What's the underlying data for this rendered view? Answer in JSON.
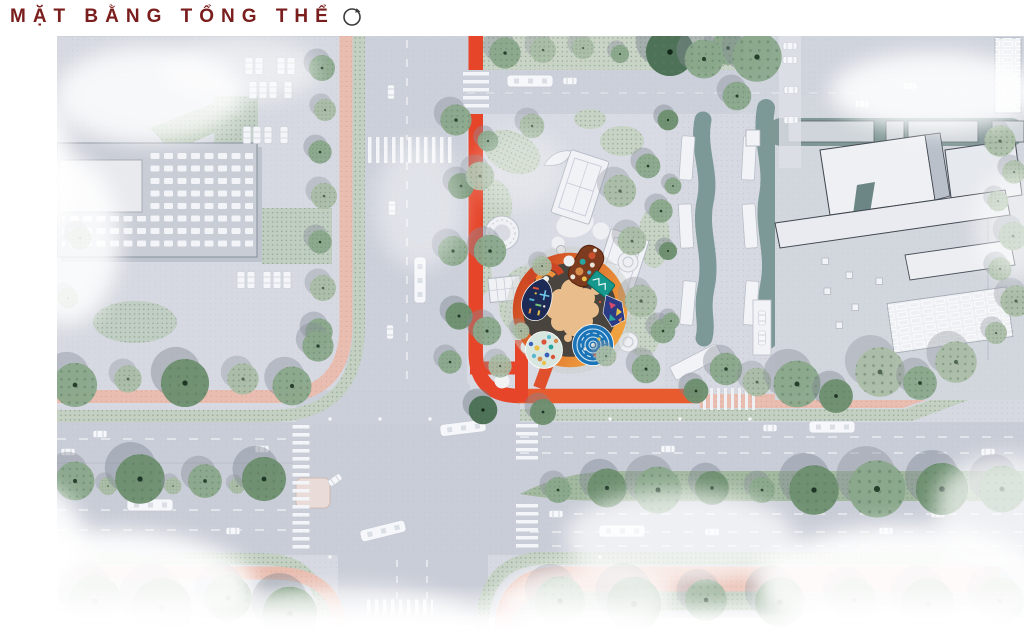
{
  "header": {
    "title": "MẶT BẰNG TỔNG THỂ",
    "compass_icon": "rotate-circle-icon"
  },
  "theme": {
    "title-color": "#7a1d1d",
    "page-bg": "#ffffff",
    "accent-red": "#e6452a",
    "ring-orange": "#ef8d35",
    "sidewalk-pink": "#e9bdb0",
    "verge-green": "#c3d0c2",
    "median-green": "#a2b89f",
    "tree-green": "#8aa88b",
    "road-gray": "#c9cdd7",
    "block-gray": "#d6d9e1",
    "building-light": "#eceef2",
    "strip-teal": "#7d9997",
    "pool-blue": "#1b74b8"
  }
}
